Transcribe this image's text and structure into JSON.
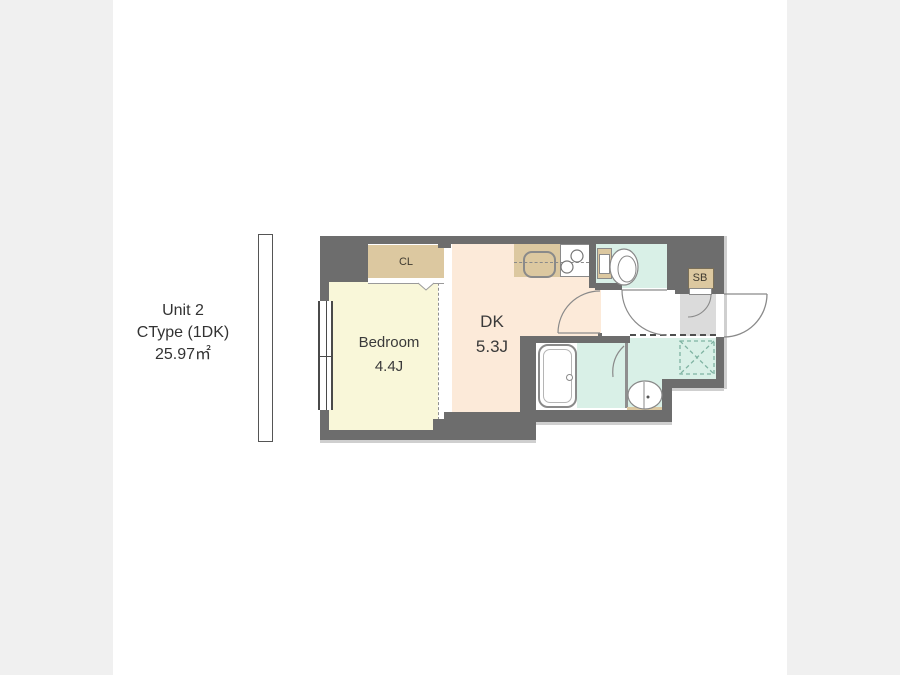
{
  "page": {
    "outer_background": "#f0f0f0",
    "content_background": "#ffffff"
  },
  "unit_info": {
    "unit": "Unit 2",
    "type": "CType (1DK)",
    "area": "25.97㎡"
  },
  "floor_plan": {
    "rooms": {
      "bedroom": {
        "name": "Bedroom",
        "size": "4.4J",
        "floor_color": "#f9f7d9"
      },
      "dining_kitchen": {
        "name": "DK",
        "size": "5.3J",
        "floor_color": "#fcead9"
      },
      "closet": {
        "label": "CL",
        "color": "#dcc8a0"
      },
      "shoe_box": {
        "label": "SB",
        "color": "#dcc8a0"
      }
    },
    "colors": {
      "wall": "#6d6d6d",
      "wet_area_floor": "#d9f0e7",
      "entrance_tile": "#dbdbdb",
      "fixture_tan": "#dcc8a0",
      "outline_shadow": "#cfcfcf"
    }
  }
}
